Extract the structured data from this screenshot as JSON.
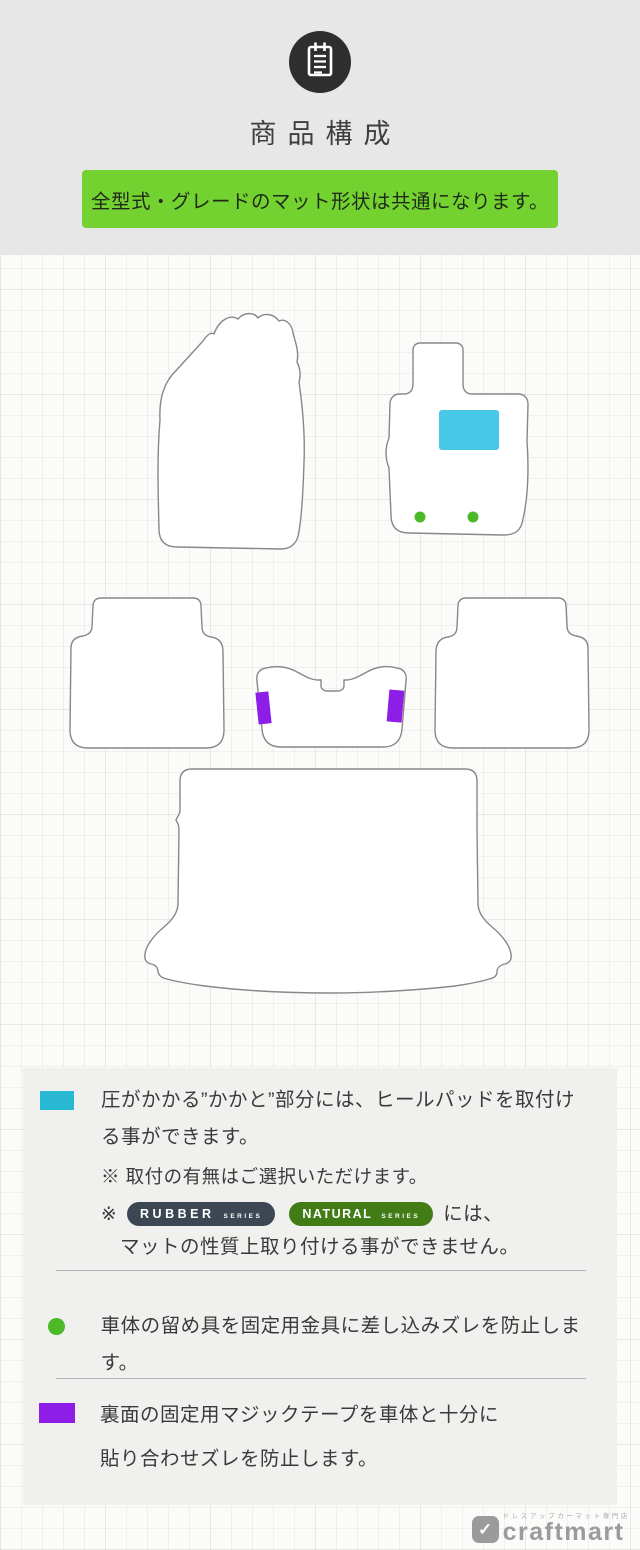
{
  "header": {
    "title": "商品構成",
    "banner": "全型式・グレードのマット形状は共通になります。"
  },
  "colors": {
    "banner_green": "#74d230",
    "heel_pad_cyan": "#48c8e8",
    "legend_cyan": "#28b8d4",
    "clip_green": "#4cba28",
    "velcro_purple": "#8e1de8",
    "rubber_badge_bg": "#3d4753",
    "natural_badge_bg": "#417c17",
    "mat_fill": "#ffffff",
    "mat_outline": "#888888"
  },
  "badges": {
    "rubber": {
      "label": "RUBBER",
      "series": "SERIES"
    },
    "natural": {
      "label": "NATURAL",
      "series": "SERIES"
    }
  },
  "legend": {
    "heelpad": {
      "line1": "圧がかかる”かかと”部分には、ヒールパッドを取付け",
      "line2": "る事ができます。",
      "note1": "※ 取付の有無はご選択いただけます。",
      "note2_prefix": "※",
      "note2_suffix": "には、",
      "note2_line2": "マットの性質上取り付ける事ができません。"
    },
    "clip": {
      "line1": "車体の留め具を固定用金具に差し込みズレを防止します。"
    },
    "velcro": {
      "line1": "裏面の固定用マジックテープを車体と十分に",
      "line2": "貼り合わせズレを防止します。"
    }
  },
  "footer": {
    "logo": "craftmart",
    "logo_icon_glyph": "✓",
    "tagline": "ドレスアップカーマット専門店"
  }
}
